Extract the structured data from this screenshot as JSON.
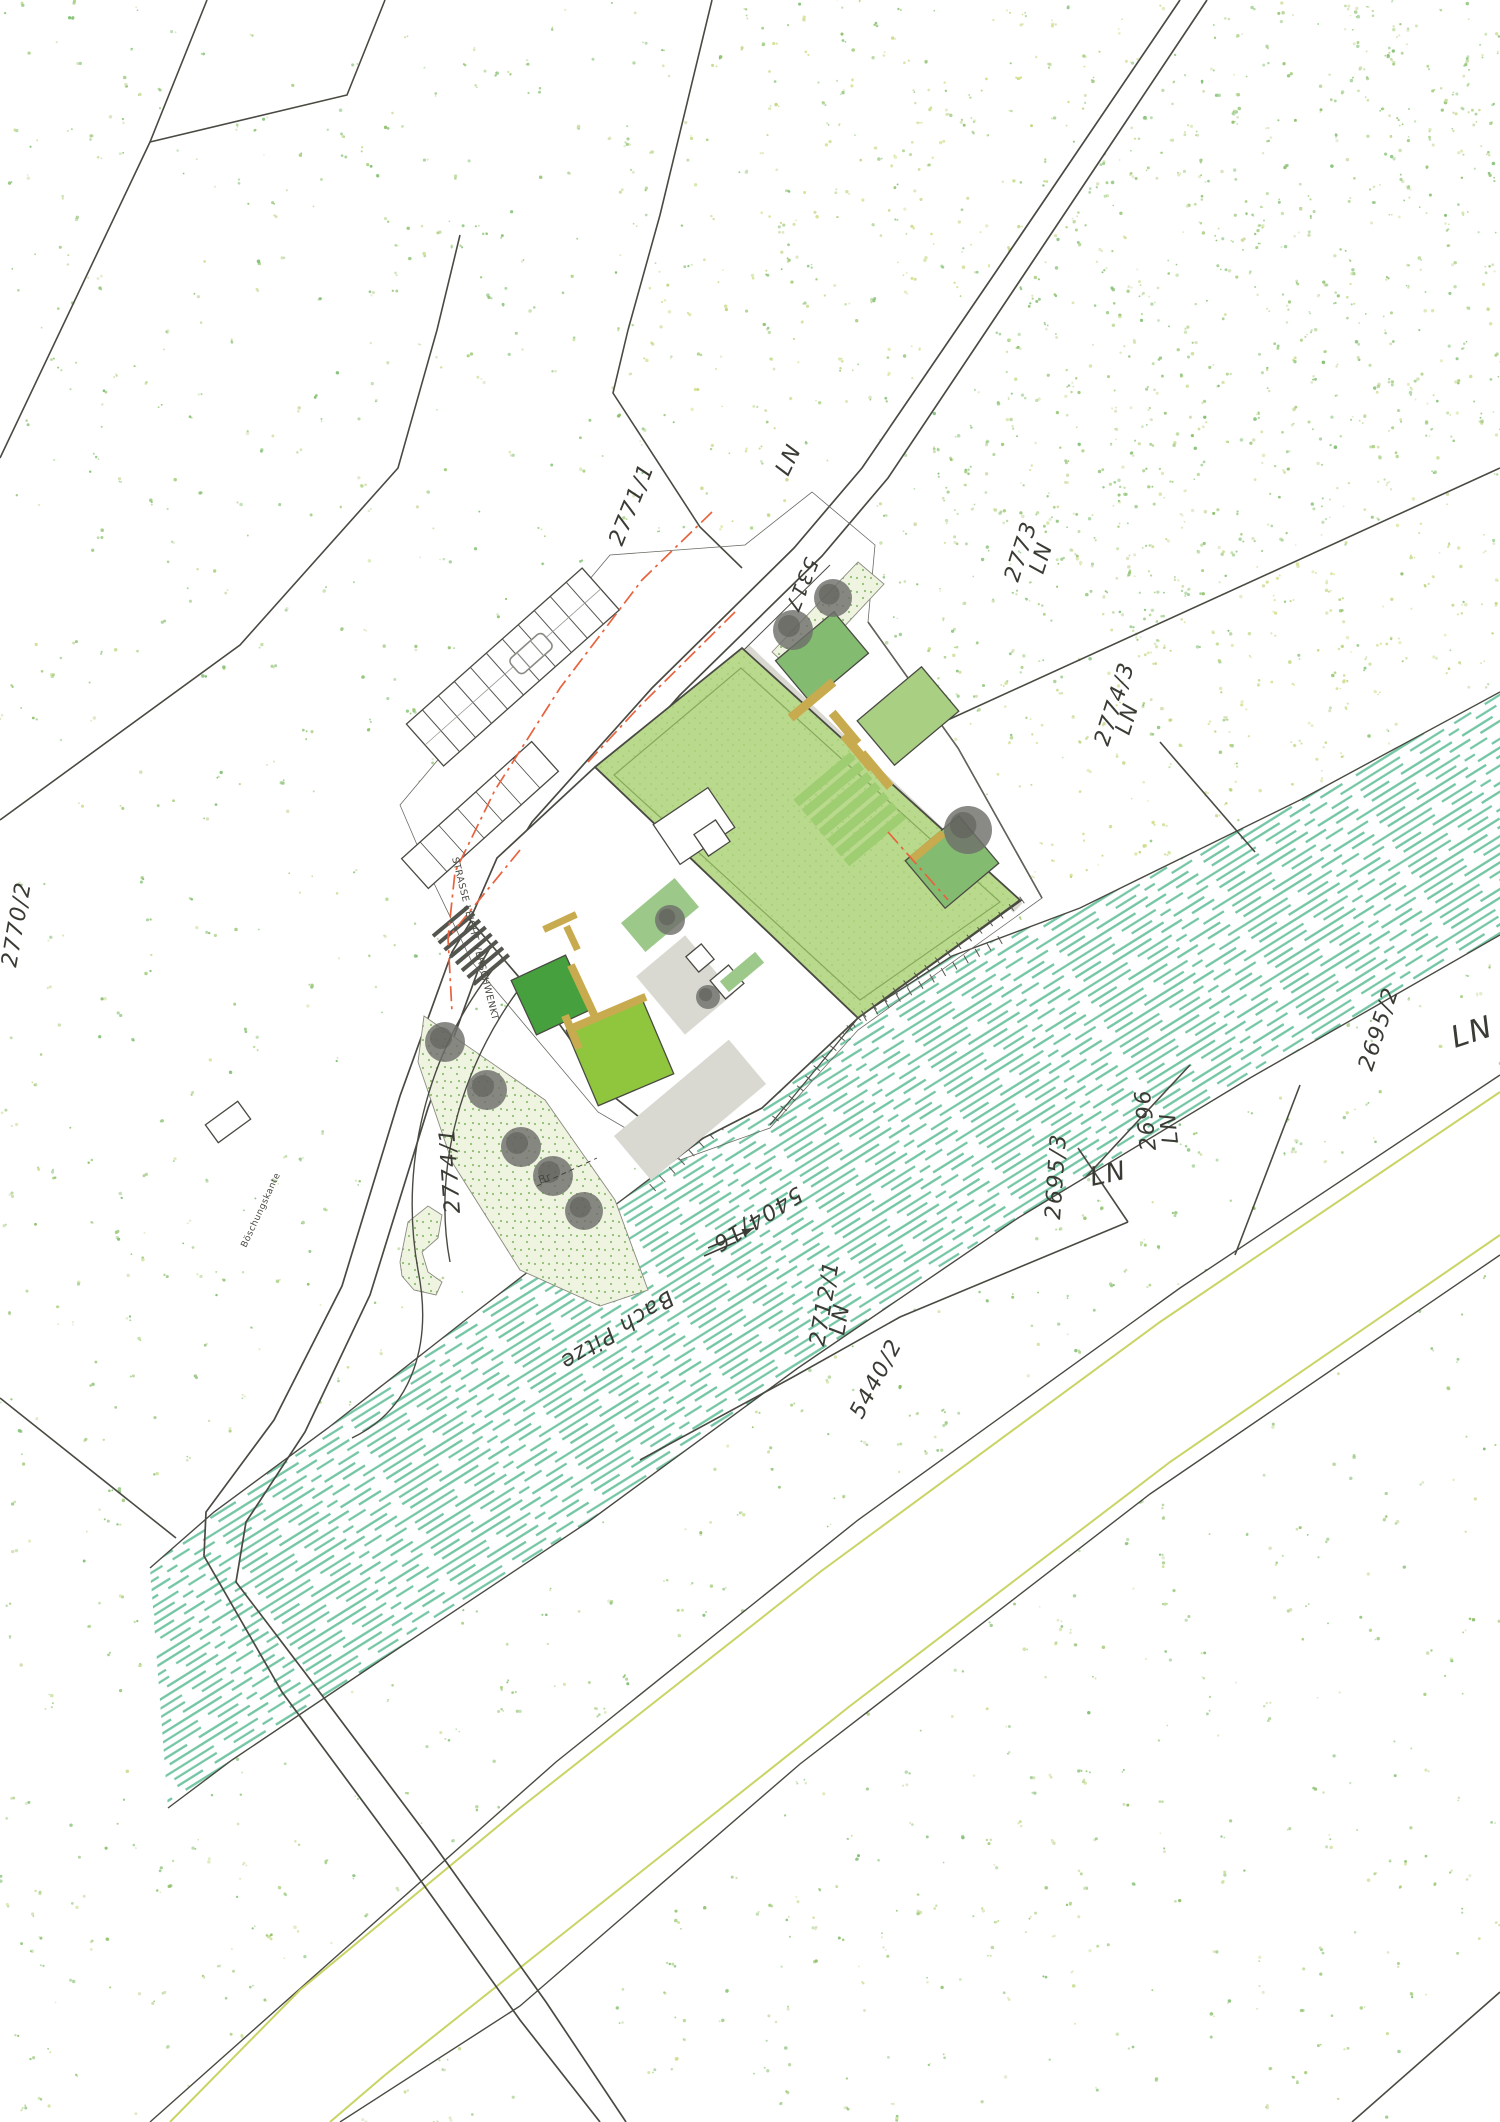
{
  "canvas": {
    "w": 1500,
    "h": 2122
  },
  "palette": {
    "line": "#4a4a43",
    "red": "#e8623d",
    "river": "#74c6a5",
    "roof_green": "#b9d98c",
    "roof_tex": "#a9cf77",
    "roof_inset": "#85aa5c",
    "court_dark": "#46a03d",
    "court_light": "#8fc63e",
    "bed_green": "#83bb70",
    "bed_light": "#a8cf82",
    "hedge": "#9cc98a",
    "bench": "#c9ab4f",
    "tree": "#6f6f6b",
    "paving": "#d9d9d2",
    "stipple_bg": "#eef4e0",
    "stipple_dot": "#8fbf72",
    "yellow_line": "#c9d465",
    "stair_green": "#9fcd72",
    "dots": [
      "#7fbf72",
      "#94c77f",
      "#a6cf7e",
      "#cbdf96",
      "#8ec06a",
      "#d0ddb0"
    ],
    "dots_yellow": [
      "#cbdf96",
      "#d3e08c",
      "#bcd47a"
    ]
  },
  "labels": [
    {
      "text": "2771/1",
      "x": 622,
      "y": 547,
      "rot": -68,
      "size": 22
    },
    {
      "text": "LN",
      "x": 788,
      "y": 477,
      "rot": -64,
      "size": 22
    },
    {
      "text": "5317",
      "x": 806,
      "y": 556,
      "rot": 112,
      "size": 20
    },
    {
      "text": "2773",
      "x": 1018,
      "y": 583,
      "rot": -72,
      "size": 22
    },
    {
      "text": "LN",
      "x": 1043,
      "y": 575,
      "rot": -72,
      "size": 22
    },
    {
      "text": "2774/3",
      "x": 1108,
      "y": 747,
      "rot": -72,
      "size": 22
    },
    {
      "text": "LN",
      "x": 1129,
      "y": 736,
      "rot": -72,
      "size": 22
    },
    {
      "text": "2695/2",
      "x": 1372,
      "y": 1072,
      "rot": -72,
      "size": 22
    },
    {
      "text": "LN",
      "x": 1455,
      "y": 1048,
      "rot": -18,
      "size": 30
    },
    {
      "text": "2696",
      "x": 1156,
      "y": 1150,
      "rot": -96,
      "size": 22
    },
    {
      "text": "LN",
      "x": 1178,
      "y": 1143,
      "rot": -96,
      "size": 22
    },
    {
      "text": "2695/3",
      "x": 1060,
      "y": 1220,
      "rot": -86,
      "size": 22
    },
    {
      "text": "LN",
      "x": 1092,
      "y": 1186,
      "rot": -12,
      "size": 26
    },
    {
      "text": "2712/1",
      "x": 824,
      "y": 1347,
      "rot": -80,
      "size": 22
    },
    {
      "text": "LN",
      "x": 844,
      "y": 1336,
      "rot": -80,
      "size": 22
    },
    {
      "text": "5440/2",
      "x": 862,
      "y": 1420,
      "rot": -62,
      "size": 22
    },
    {
      "text": "5404/16",
      "x": 797,
      "y": 1186,
      "rot": 148,
      "size": 22
    },
    {
      "text": "Bach Pitze",
      "x": 668,
      "y": 1290,
      "rot": 148,
      "size": 22
    },
    {
      "text": "2774/1",
      "x": 460,
      "y": 1213,
      "rot": -94,
      "size": 22
    },
    {
      "text": "2770/2",
      "x": 16,
      "y": 968,
      "rot": -80,
      "size": 22
    },
    {
      "text": "STRASSE LEICHT VERSCHWENKT",
      "x": 452,
      "y": 858,
      "rot": 76,
      "size": 9.5,
      "cls": "tiny"
    },
    {
      "text": "Böschungskante",
      "x": 246,
      "y": 1248,
      "rot": -65,
      "size": 9,
      "cls": "tiny"
    },
    {
      "text": "Br",
      "x": 540,
      "y": 1184,
      "rot": -20,
      "size": 11,
      "cls": "tiny"
    }
  ],
  "parcel_lines": [
    [
      [
        207,
        0
      ],
      [
        150,
        142
      ],
      [
        0,
        458
      ]
    ],
    [
      [
        385,
        0
      ],
      [
        347,
        95
      ],
      [
        150,
        142
      ]
    ],
    [
      [
        460,
        235
      ],
      [
        437,
        330
      ],
      [
        398,
        468
      ],
      [
        240,
        645
      ],
      [
        0,
        820
      ]
    ],
    [
      [
        712,
        0
      ],
      [
        660,
        215
      ],
      [
        628,
        330
      ]
    ],
    [
      [
        628,
        330
      ],
      [
        613,
        393
      ],
      [
        700,
        527
      ],
      [
        742,
        568
      ]
    ],
    [
      [
        893,
        745
      ],
      [
        1500,
        468
      ]
    ],
    [
      [
        1160,
        742
      ],
      [
        1255,
        852
      ]
    ],
    [
      [
        1078,
        1148
      ],
      [
        1128,
        1222
      ]
    ],
    [
      [
        640,
        1460
      ],
      [
        793,
        1377
      ],
      [
        900,
        1317
      ],
      [
        1128,
        1222
      ]
    ],
    [
      [
        1085,
        1178
      ],
      [
        1190,
        1065
      ]
    ],
    [
      [
        1300,
        1085
      ],
      [
        1235,
        1255
      ]
    ],
    [
      [
        1352,
        2122
      ],
      [
        1500,
        1992
      ]
    ],
    [
      [
        0,
        1398
      ],
      [
        176,
        1538
      ]
    ],
    [
      [
        868,
        622
      ],
      [
        958,
        748
      ],
      [
        1042,
        898
      ]
    ]
  ],
  "street": {
    "outer": [
      [
        1207,
        0
      ],
      [
        1017,
        285
      ],
      [
        888,
        478
      ],
      [
        822,
        556
      ],
      [
        680,
        695
      ],
      [
        560,
        830
      ],
      [
        480,
        965
      ],
      [
        428,
        1108
      ],
      [
        370,
        1295
      ],
      [
        305,
        1432
      ],
      [
        246,
        1522
      ],
      [
        236,
        1582
      ],
      [
        306,
        1674
      ],
      [
        432,
        1842
      ],
      [
        546,
        2002
      ],
      [
        626,
        2122
      ]
    ],
    "inner": [
      [
        1180,
        0
      ],
      [
        993,
        276
      ],
      [
        862,
        468
      ],
      [
        794,
        548
      ],
      [
        652,
        688
      ],
      [
        532,
        822
      ],
      [
        452,
        952
      ],
      [
        400,
        1096
      ],
      [
        342,
        1286
      ],
      [
        274,
        1420
      ],
      [
        206,
        1512
      ],
      [
        204,
        1556
      ],
      [
        282,
        1692
      ],
      [
        406,
        1860
      ],
      [
        520,
        2020
      ],
      [
        600,
        2122
      ]
    ],
    "wall": [
      [
        830,
        565
      ],
      [
        690,
        703
      ],
      [
        572,
        835
      ]
    ]
  },
  "farm_road": {
    "upper": [
      [
        1500,
        1075
      ],
      [
        1180,
        1288
      ],
      [
        858,
        1520
      ],
      [
        556,
        1762
      ],
      [
        330,
        1962
      ],
      [
        150,
        2122
      ]
    ],
    "lower": [
      [
        340,
        2122
      ],
      [
        520,
        2006
      ],
      [
        800,
        1764
      ],
      [
        1150,
        1494
      ],
      [
        1500,
        1255
      ]
    ],
    "yellow1": [
      [
        1500,
        1092
      ],
      [
        1160,
        1322
      ],
      [
        820,
        1572
      ],
      [
        520,
        1808
      ],
      [
        300,
        1990
      ],
      [
        170,
        2122
      ]
    ],
    "yellow2": [
      [
        1500,
        1235
      ],
      [
        1170,
        1462
      ],
      [
        850,
        1706
      ],
      [
        560,
        1936
      ],
      [
        385,
        2075
      ],
      [
        330,
        2122
      ]
    ]
  },
  "river": {
    "ne_bank": [
      [
        1500,
        692
      ],
      [
        1300,
        800
      ],
      [
        1080,
        908
      ],
      [
        952,
        956
      ],
      [
        820,
        1042
      ],
      [
        730,
        1118
      ],
      [
        598,
        1218
      ],
      [
        468,
        1318
      ],
      [
        328,
        1428
      ],
      [
        214,
        1512
      ],
      [
        150,
        1568
      ]
    ],
    "sw_bank": [
      [
        168,
        1808
      ],
      [
        232,
        1760
      ],
      [
        378,
        1662
      ],
      [
        588,
        1522
      ],
      [
        798,
        1368
      ],
      [
        1018,
        1218
      ],
      [
        1250,
        1078
      ],
      [
        1500,
        935
      ]
    ],
    "ticks_ne": [
      [
        1000,
        940
      ],
      [
        820,
        1042
      ],
      [
        730,
        1118
      ],
      [
        650,
        1190
      ]
    ],
    "arrows": [
      [
        [
          708,
          1248
        ],
        [
          754,
          1228
        ]
      ],
      [
        [
          704,
          1256
        ],
        [
          736,
          1242
        ]
      ]
    ]
  },
  "site": {
    "white_polys": [
      [
        [
          400,
          805
        ],
        [
          610,
          555
        ],
        [
          745,
          545
        ],
        [
          812,
          492
        ],
        [
          875,
          545
        ],
        [
          868,
          622
        ],
        [
          958,
          748
        ],
        [
          1042,
          898
        ],
        [
          858,
          1030
        ],
        [
          770,
          1128
        ],
        [
          680,
          1160
        ],
        [
          598,
          1112
        ],
        [
          472,
          962
        ],
        [
          430,
          875
        ]
      ],
      [
        [
          400,
          960
        ],
        [
          560,
          1080
        ],
        [
          660,
          1250
        ],
        [
          660,
          1340
        ],
        [
          540,
          1330
        ],
        [
          420,
          1260
        ],
        [
          358,
          1118
        ]
      ]
    ],
    "green_roof": [
      [
        595,
        767
      ],
      [
        742,
        648
      ],
      [
        1020,
        900
      ],
      [
        858,
        1018
      ]
    ],
    "roof_inset": [
      [
        614,
        775
      ],
      [
        741,
        668
      ],
      [
        1000,
        902
      ],
      [
        860,
        1000
      ]
    ],
    "building": [
      [
        595,
        767
      ],
      [
        497,
        858
      ],
      [
        470,
        920
      ],
      [
        560,
        1025
      ],
      [
        608,
        1092
      ],
      [
        680,
        1150
      ],
      [
        762,
        1108
      ],
      [
        858,
        1018
      ]
    ],
    "stipples": [
      [
        [
          424,
          1016
        ],
        [
          545,
          1100
        ],
        [
          615,
          1200
        ],
        [
          648,
          1290
        ],
        [
          600,
          1306
        ],
        [
          520,
          1270
        ],
        [
          452,
          1162
        ],
        [
          418,
          1062
        ]
      ],
      [
        [
          400,
          1262
        ],
        [
          408,
          1222
        ],
        [
          428,
          1206
        ],
        [
          442,
          1215
        ],
        [
          438,
          1238
        ],
        [
          422,
          1252
        ],
        [
          428,
          1272
        ],
        [
          442,
          1282
        ],
        [
          436,
          1295
        ],
        [
          414,
          1290
        ],
        [
          402,
          1276
        ]
      ],
      [
        [
          772,
          652
        ],
        [
          858,
          562
        ],
        [
          884,
          584
        ],
        [
          798,
          676
        ]
      ]
    ],
    "curves": [
      "M 505 955 C 430 1040 398 1160 418 1270 C 432 1340 415 1408 352 1438",
      "M 530 975 C 462 1058 432 1168 450 1262"
    ],
    "walkway": [
      [
        745,
        650
      ],
      [
        1018,
        908
      ]
    ],
    "dock": [
      [
        1022,
        900
      ],
      [
        858,
        1018
      ],
      [
        770,
        1125
      ]
    ],
    "structures": [
      {
        "cx": 480,
        "cy": 815,
        "w": 175,
        "h": 40,
        "rot": -42,
        "fill": "#ffffff",
        "stroke": true,
        "ticks": 7
      },
      {
        "cx": 694,
        "cy": 826,
        "w": 66,
        "h": 48,
        "rot": -34,
        "fill": "#ffffff",
        "stroke": true
      },
      {
        "cx": 712,
        "cy": 838,
        "w": 26,
        "h": 26,
        "rot": -34,
        "fill": "#ffffff",
        "stroke": true
      },
      {
        "cx": 551,
        "cy": 995,
        "w": 60,
        "h": 60,
        "rot": -25,
        "fill": "court_dark",
        "stroke": true
      },
      {
        "cx": 620,
        "cy": 1052,
        "w": 82,
        "h": 82,
        "rot": -23,
        "fill": "court_light",
        "stroke": true
      },
      {
        "cx": 822,
        "cy": 657,
        "w": 76,
        "h": 54,
        "rot": -40,
        "fill": "bed_green",
        "stroke": true
      },
      {
        "cx": 908,
        "cy": 716,
        "w": 84,
        "h": 58,
        "rot": -40,
        "fill": "bed_light",
        "stroke": true
      },
      {
        "cx": 952,
        "cy": 862,
        "w": 70,
        "h": 62,
        "rot": -40,
        "fill": "bed_green",
        "stroke": true
      },
      {
        "cx": 660,
        "cy": 915,
        "w": 70,
        "h": 38,
        "rot": -40,
        "fill": "hedge"
      },
      {
        "cx": 685,
        "cy": 985,
        "w": 64,
        "h": 76,
        "rot": -40,
        "fill": "paving"
      },
      {
        "cx": 690,
        "cy": 1110,
        "w": 150,
        "h": 58,
        "rot": -40,
        "fill": "paving"
      },
      {
        "cx": 727,
        "cy": 982,
        "w": 24,
        "h": 24,
        "rot": -40,
        "fill": "#ffffff",
        "stroke": true
      },
      {
        "cx": 700,
        "cy": 958,
        "w": 20,
        "h": 20,
        "rot": -40,
        "fill": "#ffffff",
        "stroke": true
      },
      {
        "cx": 742,
        "cy": 972,
        "w": 46,
        "h": 14,
        "rot": -40,
        "fill": "hedge"
      },
      {
        "cx": 228,
        "cy": 1122,
        "w": 40,
        "h": 22,
        "rot": -36,
        "fill": "#ffffff",
        "stroke": true
      }
    ],
    "benches": [
      {
        "cx": 560,
        "cy": 922,
        "w": 36,
        "h": 7,
        "rot": -25
      },
      {
        "cx": 572,
        "cy": 938,
        "w": 7,
        "h": 26,
        "rot": -25
      },
      {
        "cx": 584,
        "cy": 993,
        "w": 8,
        "h": 62,
        "rot": -25
      },
      {
        "cx": 610,
        "cy": 1012,
        "w": 78,
        "h": 8,
        "rot": -23
      },
      {
        "cx": 572,
        "cy": 1032,
        "w": 8,
        "h": 36,
        "rot": -23
      },
      {
        "cx": 812,
        "cy": 700,
        "w": 56,
        "h": 9,
        "rot": -40
      },
      {
        "cx": 845,
        "cy": 728,
        "w": 9,
        "h": 40,
        "rot": -40
      },
      {
        "cx": 858,
        "cy": 752,
        "w": 9,
        "h": 44,
        "rot": -40
      },
      {
        "cx": 876,
        "cy": 770,
        "w": 9,
        "h": 44,
        "rot": -40
      },
      {
        "cx": 928,
        "cy": 846,
        "w": 40,
        "h": 8,
        "rot": -40
      }
    ],
    "stairs_entry": {
      "x": 467,
      "y": 905,
      "rot": 50,
      "n": 8,
      "step": 9,
      "len": 46
    },
    "stairs_garden": {
      "x": 850,
      "y": 752,
      "rot": 50,
      "n": 7,
      "step": 13,
      "len": 74
    },
    "parking": {
      "x": 425,
      "y": 745,
      "angle": -41.6,
      "len": 235,
      "width": 56,
      "stalls": 11,
      "car_at": 140
    },
    "trees": [
      {
        "x": 833,
        "y": 598,
        "r": 19
      },
      {
        "x": 793,
        "y": 630,
        "r": 20
      },
      {
        "x": 968,
        "y": 830,
        "r": 24
      },
      {
        "x": 670,
        "y": 920,
        "r": 15
      },
      {
        "x": 708,
        "y": 997,
        "r": 12
      },
      {
        "x": 445,
        "y": 1042,
        "r": 20
      },
      {
        "x": 487,
        "y": 1090,
        "r": 20
      },
      {
        "x": 521,
        "y": 1147,
        "r": 20
      },
      {
        "x": 553,
        "y": 1176,
        "r": 20
      },
      {
        "x": 584,
        "y": 1211,
        "r": 19
      }
    ],
    "leader": [
      [
        537,
        1186
      ],
      [
        597,
        1158
      ]
    ]
  },
  "red_lines": [
    [
      [
        712,
        512
      ],
      [
        642,
        580
      ],
      [
        560,
        688
      ],
      [
        495,
        790
      ],
      [
        455,
        872
      ],
      [
        448,
        938
      ],
      [
        452,
        1012
      ]
    ],
    [
      [
        520,
        850
      ],
      [
        448,
        938
      ]
    ],
    [
      [
        735,
        612
      ],
      [
        640,
        706
      ],
      [
        588,
        762
      ]
    ],
    [
      [
        888,
        832
      ],
      [
        948,
        900
      ]
    ]
  ],
  "dot_regions": {
    "dense_2773": [
      [
        860,
        555
      ],
      [
        1200,
        0
      ],
      [
        1500,
        0
      ],
      [
        1500,
        465
      ],
      [
        895,
        745
      ],
      [
        868,
        622
      ]
    ],
    "yellow_2774_3": [
      [
        895,
        750
      ],
      [
        1500,
        470
      ],
      [
        1500,
        688
      ],
      [
        1205,
        845
      ],
      [
        1040,
        893
      ],
      [
        958,
        750
      ]
    ],
    "yellow_ne": [
      [
        628,
        330
      ],
      [
        700,
        60
      ],
      [
        718,
        0
      ],
      [
        1185,
        0
      ],
      [
        1000,
        280
      ],
      [
        865,
        480
      ],
      [
        742,
        565
      ],
      [
        700,
        527
      ],
      [
        613,
        393
      ]
    ]
  }
}
